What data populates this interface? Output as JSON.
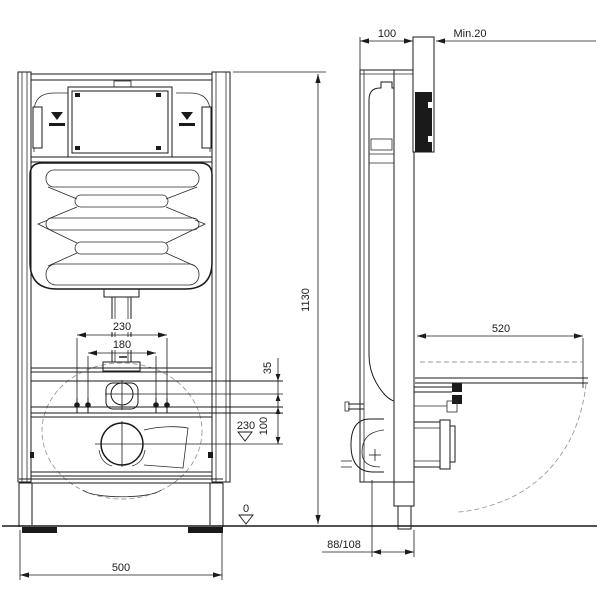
{
  "drawing_type": "installation-frame-technical-drawing",
  "colors": {
    "ink": "#1a1a1a",
    "faint_dash": "#9a9a9a",
    "background": "#ffffff"
  },
  "front_view": {
    "dim_frame_width": "500",
    "dim_frame_height": "1130",
    "dim_flushpipe_outer": "230",
    "dim_flushpipe_inner": "180",
    "dim_bracket_offset": "35",
    "dim_bolt_to_outlet": "100",
    "level_outlet": "230",
    "level_floor": "0"
  },
  "side_view": {
    "dim_frame_depth": "100",
    "dim_wall_clearance": "Min.20",
    "dim_bowl_projection": "520",
    "dim_outlet_pipe": "88/108"
  }
}
